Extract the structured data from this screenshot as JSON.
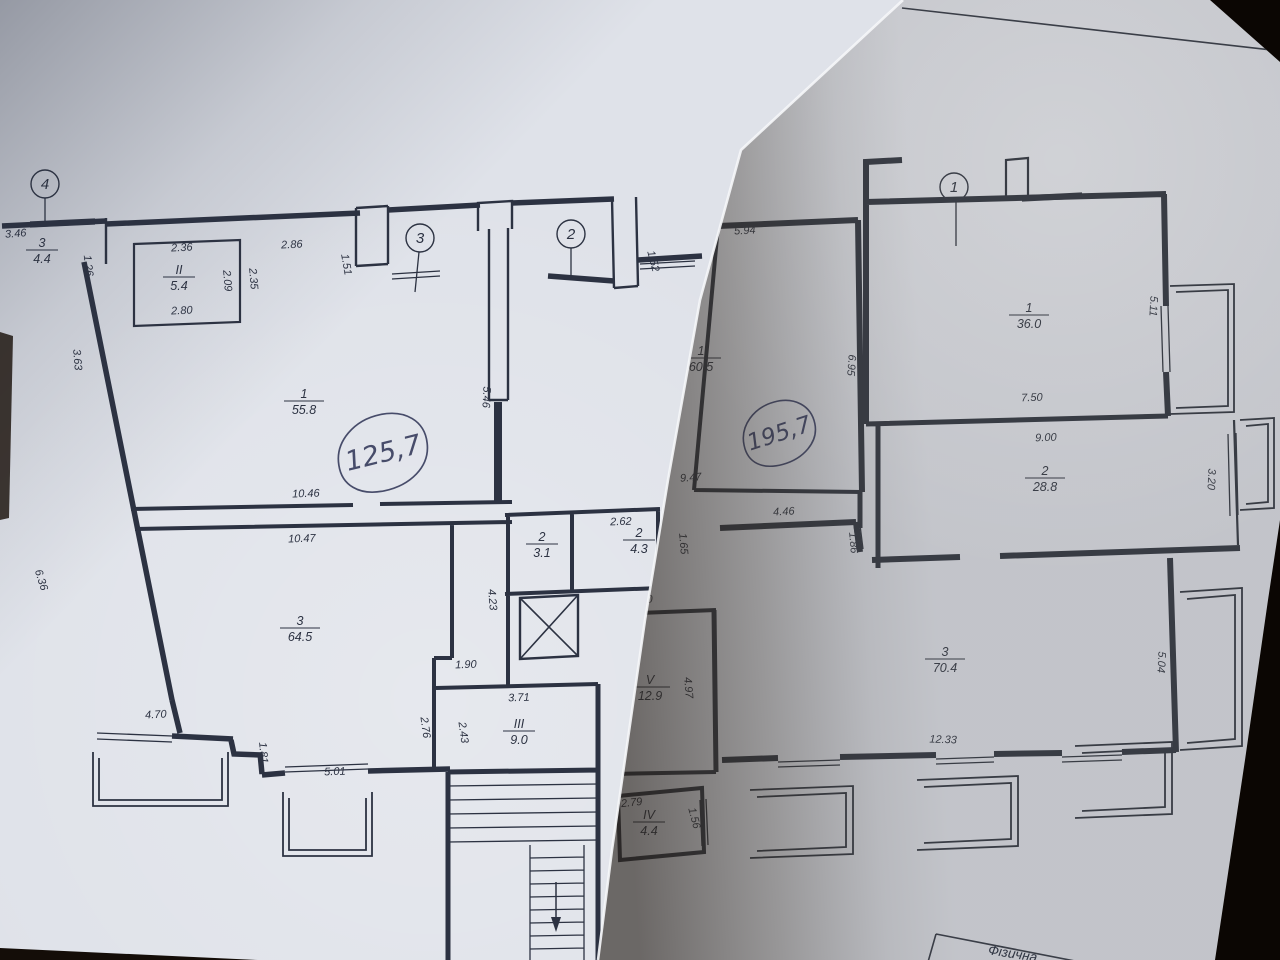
{
  "scene": {
    "background_color": "#140d08",
    "paper_left_color": "#dfe2e9",
    "paper_right_color": "#c7c9cf",
    "ink_left_color": "#2c3242",
    "ink_right_color": "#3a3e48",
    "pen_color": "#474c6a"
  },
  "left_sheet": {
    "handwritten_total": "125,7",
    "axis_markers": [
      {
        "label": "4",
        "x": 45,
        "y": 184
      },
      {
        "label": "3",
        "x": 420,
        "y": 238
      },
      {
        "label": "2",
        "x": 571,
        "y": 234
      }
    ],
    "rooms": [
      {
        "num": "3",
        "area": "4.4",
        "x": 42,
        "y": 250
      },
      {
        "num": "II",
        "area": "5.4",
        "x": 179,
        "y": 277
      },
      {
        "num": "1",
        "area": "55.8",
        "x": 304,
        "y": 401
      },
      {
        "num": "2",
        "area": "3.1",
        "x": 542,
        "y": 544
      },
      {
        "num": "2",
        "area": "4.3",
        "x": 639,
        "y": 540
      },
      {
        "num": "3",
        "area": "64.5",
        "x": 300,
        "y": 628
      },
      {
        "num": "III",
        "area": "9.0",
        "x": 519,
        "y": 731
      }
    ],
    "dimensions": [
      {
        "t": "3.46",
        "x": 16,
        "y": 237,
        "r": -4
      },
      {
        "t": "1.26",
        "x": 85,
        "y": 266,
        "r": 83
      },
      {
        "t": "3.63",
        "x": 74,
        "y": 360,
        "r": 85
      },
      {
        "t": "6.36",
        "x": 38,
        "y": 581,
        "r": 72
      },
      {
        "t": "2.36",
        "x": 182,
        "y": 251,
        "r": -3
      },
      {
        "t": "2.86",
        "x": 292,
        "y": 248,
        "r": -3
      },
      {
        "t": "1.51",
        "x": 343,
        "y": 265,
        "r": 80
      },
      {
        "t": "2.09",
        "x": 224,
        "y": 281,
        "r": 85
      },
      {
        "t": "2.35",
        "x": 250,
        "y": 279,
        "r": 85
      },
      {
        "t": "2.80",
        "x": 182,
        "y": 314,
        "r": -3
      },
      {
        "t": "1.52",
        "x": 650,
        "y": 262,
        "r": 75
      },
      {
        "t": "5.46",
        "x": 483,
        "y": 397,
        "r": 93
      },
      {
        "t": "10.46",
        "x": 306,
        "y": 497,
        "r": -2
      },
      {
        "t": "10.47",
        "x": 302,
        "y": 542,
        "r": -2
      },
      {
        "t": "2.62",
        "x": 621,
        "y": 525,
        "r": -2
      },
      {
        "t": "4.23",
        "x": 489,
        "y": 600,
        "r": 85
      },
      {
        "t": "1.90",
        "x": 466,
        "y": 668,
        "r": -2
      },
      {
        "t": "2.76",
        "x": 422,
        "y": 728,
        "r": 82
      },
      {
        "t": "2.43",
        "x": 460,
        "y": 733,
        "r": 82
      },
      {
        "t": "3.71",
        "x": 519,
        "y": 701,
        "r": -2
      },
      {
        "t": "4.70",
        "x": 156,
        "y": 718,
        "r": -3
      },
      {
        "t": "1.81",
        "x": 260,
        "y": 753,
        "r": 85
      },
      {
        "t": "5.01",
        "x": 335,
        "y": 775,
        "r": -2
      }
    ]
  },
  "right_sheet": {
    "handwritten_total": "195,7",
    "caption_partial": "Фізична",
    "axis_markers": [
      {
        "label": "1",
        "x": 954,
        "y": 187
      }
    ],
    "rooms": [
      {
        "num": "1",
        "area": "60.5",
        "x": 701,
        "y": 358
      },
      {
        "num": "1",
        "area": "36.0",
        "x": 1029,
        "y": 315
      },
      {
        "num": "2",
        "area": "28.8",
        "x": 1045,
        "y": 478
      },
      {
        "num": "3",
        "area": "70.4",
        "x": 945,
        "y": 659
      },
      {
        "num": "V",
        "area": "12.9",
        "x": 650,
        "y": 687
      },
      {
        "num": "IV",
        "area": "4.4",
        "x": 649,
        "y": 822
      }
    ],
    "dimensions": [
      {
        "t": "5.94",
        "x": 745,
        "y": 234,
        "r": -3
      },
      {
        "t": "6.95",
        "x": 848,
        "y": 365,
        "r": 94
      },
      {
        "t": "9.47",
        "x": 691,
        "y": 481,
        "r": -4
      },
      {
        "t": "4.46",
        "x": 784,
        "y": 515,
        "r": -3
      },
      {
        "t": "1.86",
        "x": 850,
        "y": 543,
        "r": 85
      },
      {
        "t": "1.65",
        "x": 680,
        "y": 544,
        "r": 85
      },
      {
        "t": "2.60",
        "x": 642,
        "y": 603,
        "r": -2
      },
      {
        "t": "4.97",
        "x": 685,
        "y": 688,
        "r": 85
      },
      {
        "t": "2.79",
        "x": 632,
        "y": 806,
        "r": -6
      },
      {
        "t": "1.56",
        "x": 691,
        "y": 819,
        "r": 75
      },
      {
        "t": "5.11",
        "x": 1150,
        "y": 306,
        "r": 93
      },
      {
        "t": "7.50",
        "x": 1032,
        "y": 401,
        "r": -2
      },
      {
        "t": "9.00",
        "x": 1046,
        "y": 441,
        "r": -2
      },
      {
        "t": "3.20",
        "x": 1208,
        "y": 479,
        "r": 93
      },
      {
        "t": "12.33",
        "x": 943,
        "y": 743,
        "r": 2
      },
      {
        "t": "5.04",
        "x": 1158,
        "y": 662,
        "r": 93
      }
    ]
  }
}
